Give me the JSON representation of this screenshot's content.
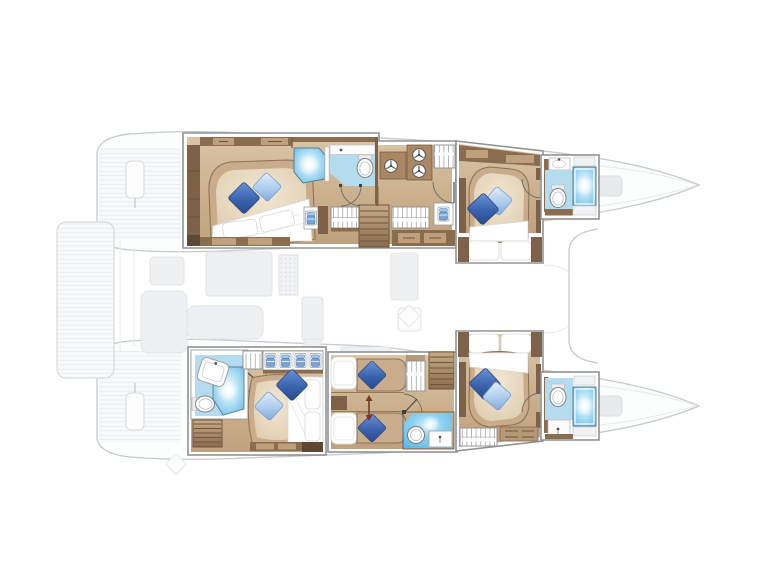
{
  "page": {
    "title": "Catamaran layout floor plan",
    "description": "Top-down deck plan of a six-cabin sailing catamaran; both hull interiors are highlighted in white panels showing beds with blue pillows, bathrooms with showers, wardrobes and companionway stairs; the bridgedeck, cockpit, bows and aft swim platform are shown as a faint grey outline.",
    "background": "#ffffff"
  },
  "colors": {
    "panelBorder": "#909294",
    "faintLine": "#c7c9cc",
    "faintFill": "#fcfdfd",
    "faintFurniture": "#eef0f1",
    "faintFurnitureLine": "#e2e3e6",
    "plankLine": "#e8eaec",
    "wallBrown": "#8a6c4e",
    "furnDark": "#7d6148",
    "furnDeep": "#5f4833",
    "furnMid": "#a98762",
    "drawerFace": "#bfa07c",
    "floorTop": "#d9c5a7",
    "floorBottom": "#bfa17d",
    "bedTan": "#c9ac8b",
    "bedEdge": "#8f7356",
    "bedInnerLight": "#f2e7d3",
    "duvet": "#ffffff",
    "pillowDark": "#3a63ad",
    "pillowDarkDeep": "#27498c",
    "pillowLight": "#a9c9ec",
    "bathFloor": "#b5dbee",
    "showerBlue": "#54aedd",
    "wetFloor": "#4eb6e6",
    "stairLight": "#c9ab89",
    "stairDark": "#8a6b4c",
    "treadLine": "#6e563c",
    "arrowRed": "#7c3526",
    "doorArc": "#6a6a6a"
  },
  "rooms": {
    "portAftCabin": {
      "label": "Port aft double cabin"
    },
    "portAftBathroom": {
      "label": "Port aft shower room"
    },
    "portCompanionway": {
      "label": "Port companionway with stairs and lockers"
    },
    "portForwardCabin": {
      "label": "Port forward double cabin"
    },
    "portForwardBathroom": {
      "label": "Port forward bathroom"
    },
    "stbdAftCabin": {
      "label": "Starboard aft double cabin"
    },
    "stbdAftBathroom": {
      "label": "Starboard aft bathroom"
    },
    "stbdTwinCabin": {
      "label": "Starboard twin cabin with sliding single beds"
    },
    "stbdMidBathroom": {
      "label": "Starboard shower wet room"
    },
    "stbdForwardCabin": {
      "label": "Starboard forward double cabin"
    },
    "stbdForwardBathroom": {
      "label": "Starboard forward bathroom"
    }
  },
  "deck": {
    "aftPlatform": {
      "label": "Aft swim platform"
    },
    "cockpit": {
      "label": "Aft cockpit seating"
    },
    "saloon": {
      "label": "Saloon and galley"
    },
    "foredeck": {
      "label": "Foredeck"
    },
    "bows": {
      "label": "Twin bows with sun pads"
    }
  },
  "icons": [
    {
      "name": "double-bed",
      "meaning": "Double berth with duvet and pillows"
    },
    {
      "name": "single-bed",
      "meaning": "Single berth"
    },
    {
      "name": "pillow",
      "meaning": "Decorative pillow"
    },
    {
      "name": "shower-icon",
      "meaning": "Shower cubicle"
    },
    {
      "name": "toilet-icon",
      "meaning": "Marine toilet"
    },
    {
      "name": "sink-icon",
      "meaning": "Washbasin with faucet"
    },
    {
      "name": "stairs-icon",
      "meaning": "Companionway steps"
    },
    {
      "name": "hanging-locker-icon",
      "meaning": "Hanging wardrobe"
    },
    {
      "name": "linen-shelf-icon",
      "meaning": "Locker with folded blue linen"
    },
    {
      "name": "vent-hatch-icon",
      "meaning": "Ventilation hatch"
    },
    {
      "name": "door-swing-icon",
      "meaning": "Door swing arc"
    },
    {
      "name": "slide-arrow-icon",
      "meaning": "Single beds slide together"
    }
  ]
}
